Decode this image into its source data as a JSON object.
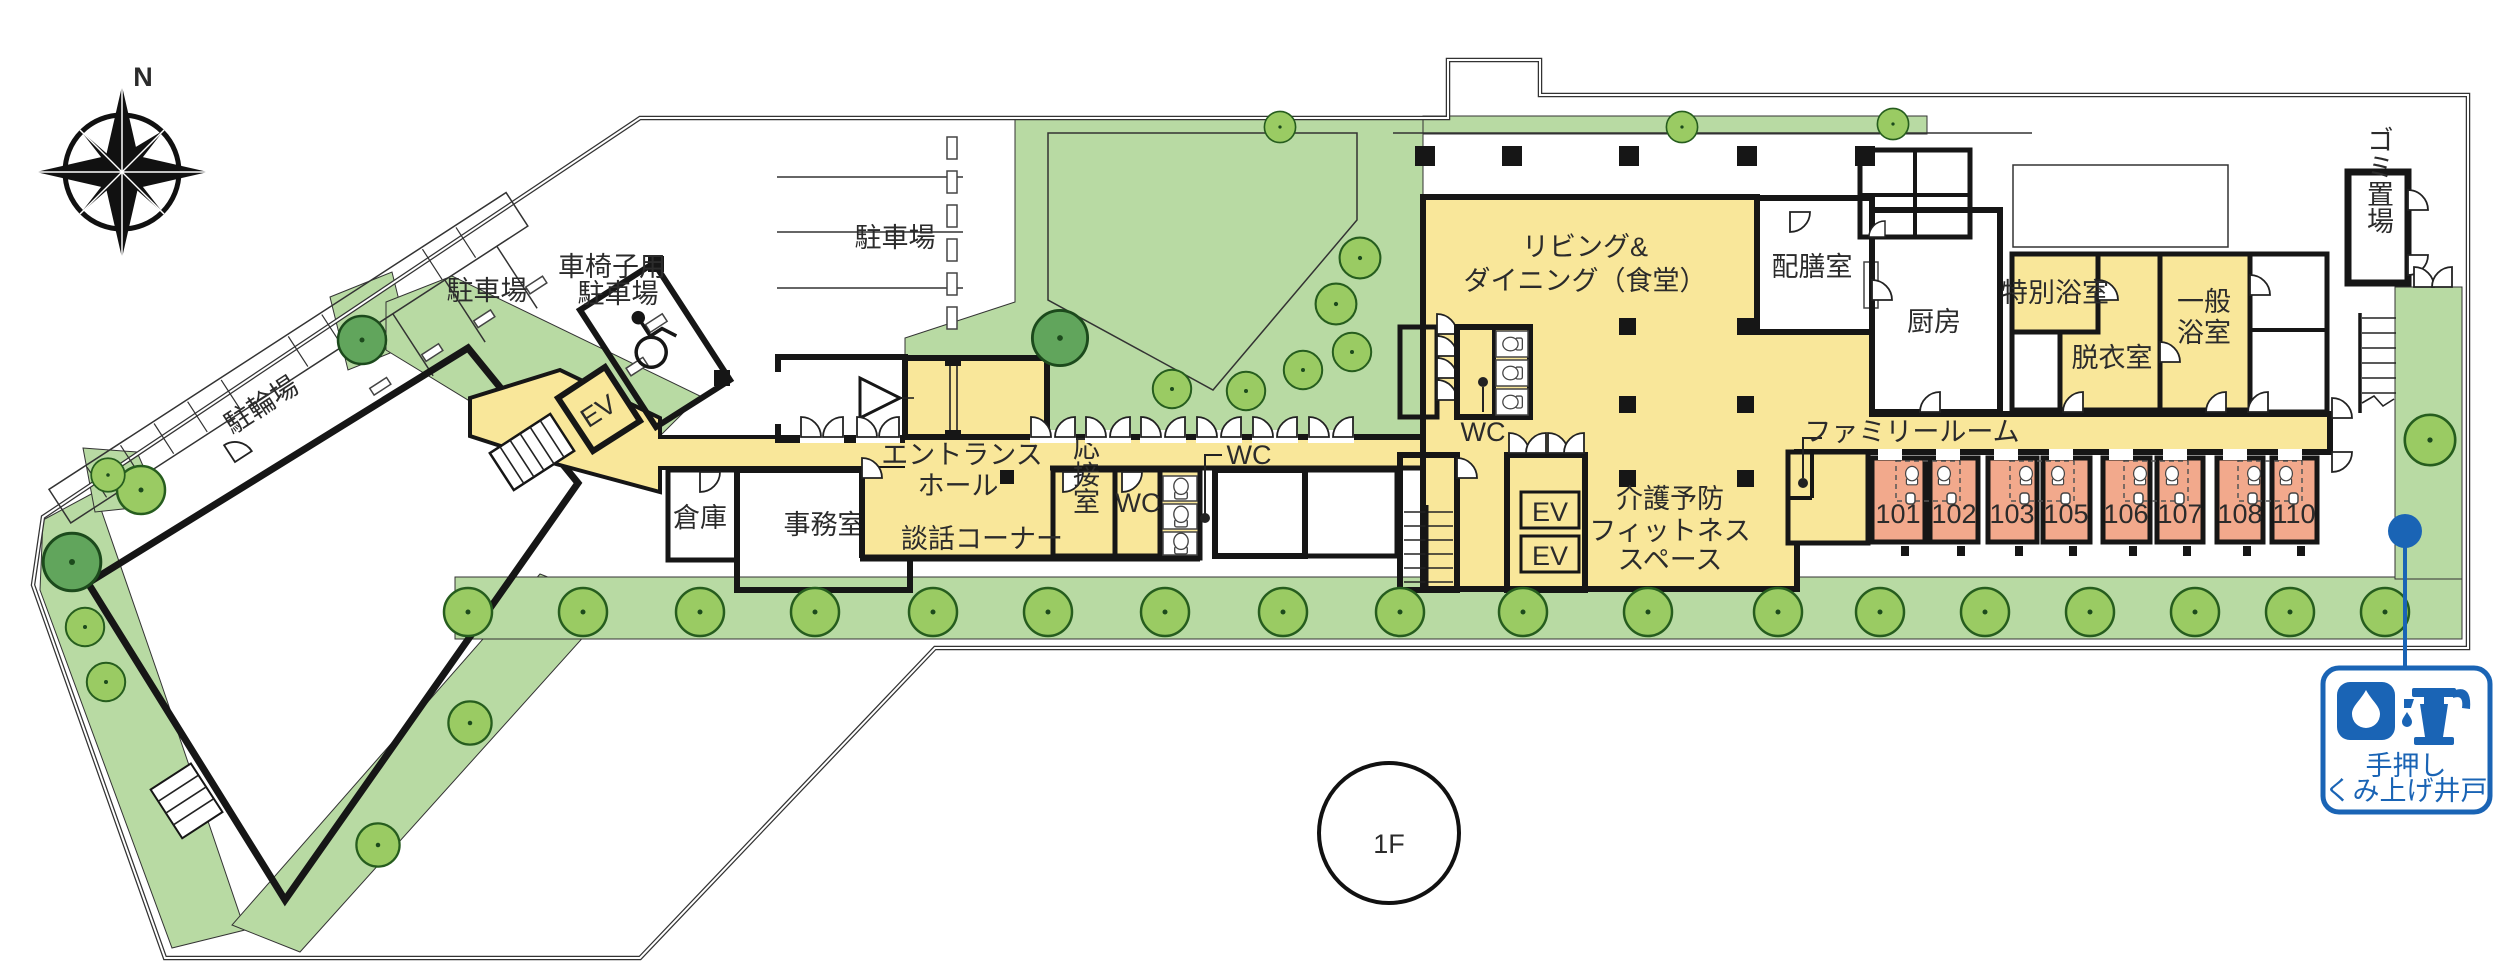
{
  "plan": {
    "floor_label": "1F",
    "compass_label": "N",
    "labels": {
      "bicycle_parking": "駐輪場",
      "parking_west": "駐車場",
      "parking_north": "駐車場",
      "wheelchair_parking_1": "車椅子用",
      "wheelchair_parking_2": "駐車場",
      "ev_left": "EV",
      "entrance_hall_1": "エントランス",
      "entrance_hall_2": "ホール",
      "storage": "倉庫",
      "office": "事務室",
      "lounge_corner": "談話コーナー",
      "reception_room": "応接室",
      "wc_hall": "WC",
      "wc_corridor": "WC",
      "wc_living": "WC",
      "living_dining_1": "リビング&",
      "living_dining_2": "ダイニング（食堂）",
      "serving_room": "配膳室",
      "kitchen": "厨房",
      "special_bath": "特別浴室",
      "changing_room": "脱衣室",
      "general_bath_1": "一般",
      "general_bath_2": "浴室",
      "garbage_area": "ゴミ置場",
      "family_room": "ファミリールーム",
      "fitness_1": "介護予防",
      "fitness_2": "フィットネス",
      "fitness_3": "スペース",
      "ev_1": "EV",
      "ev_2": "EV",
      "well_1": "手押し",
      "well_2": "くみ上げ井戸"
    },
    "room_numbers": [
      "101",
      "102",
      "103",
      "105",
      "106",
      "107",
      "108",
      "110"
    ],
    "colors": {
      "room_fill": "#F9E79A",
      "guest_room_fill": "#F2A98C",
      "greenery": "#B8DAA3",
      "tree_light": "#9ACB63",
      "tree_dark": "#61A55C",
      "wall": "#161616",
      "well_blue": "#1A64B5"
    }
  }
}
